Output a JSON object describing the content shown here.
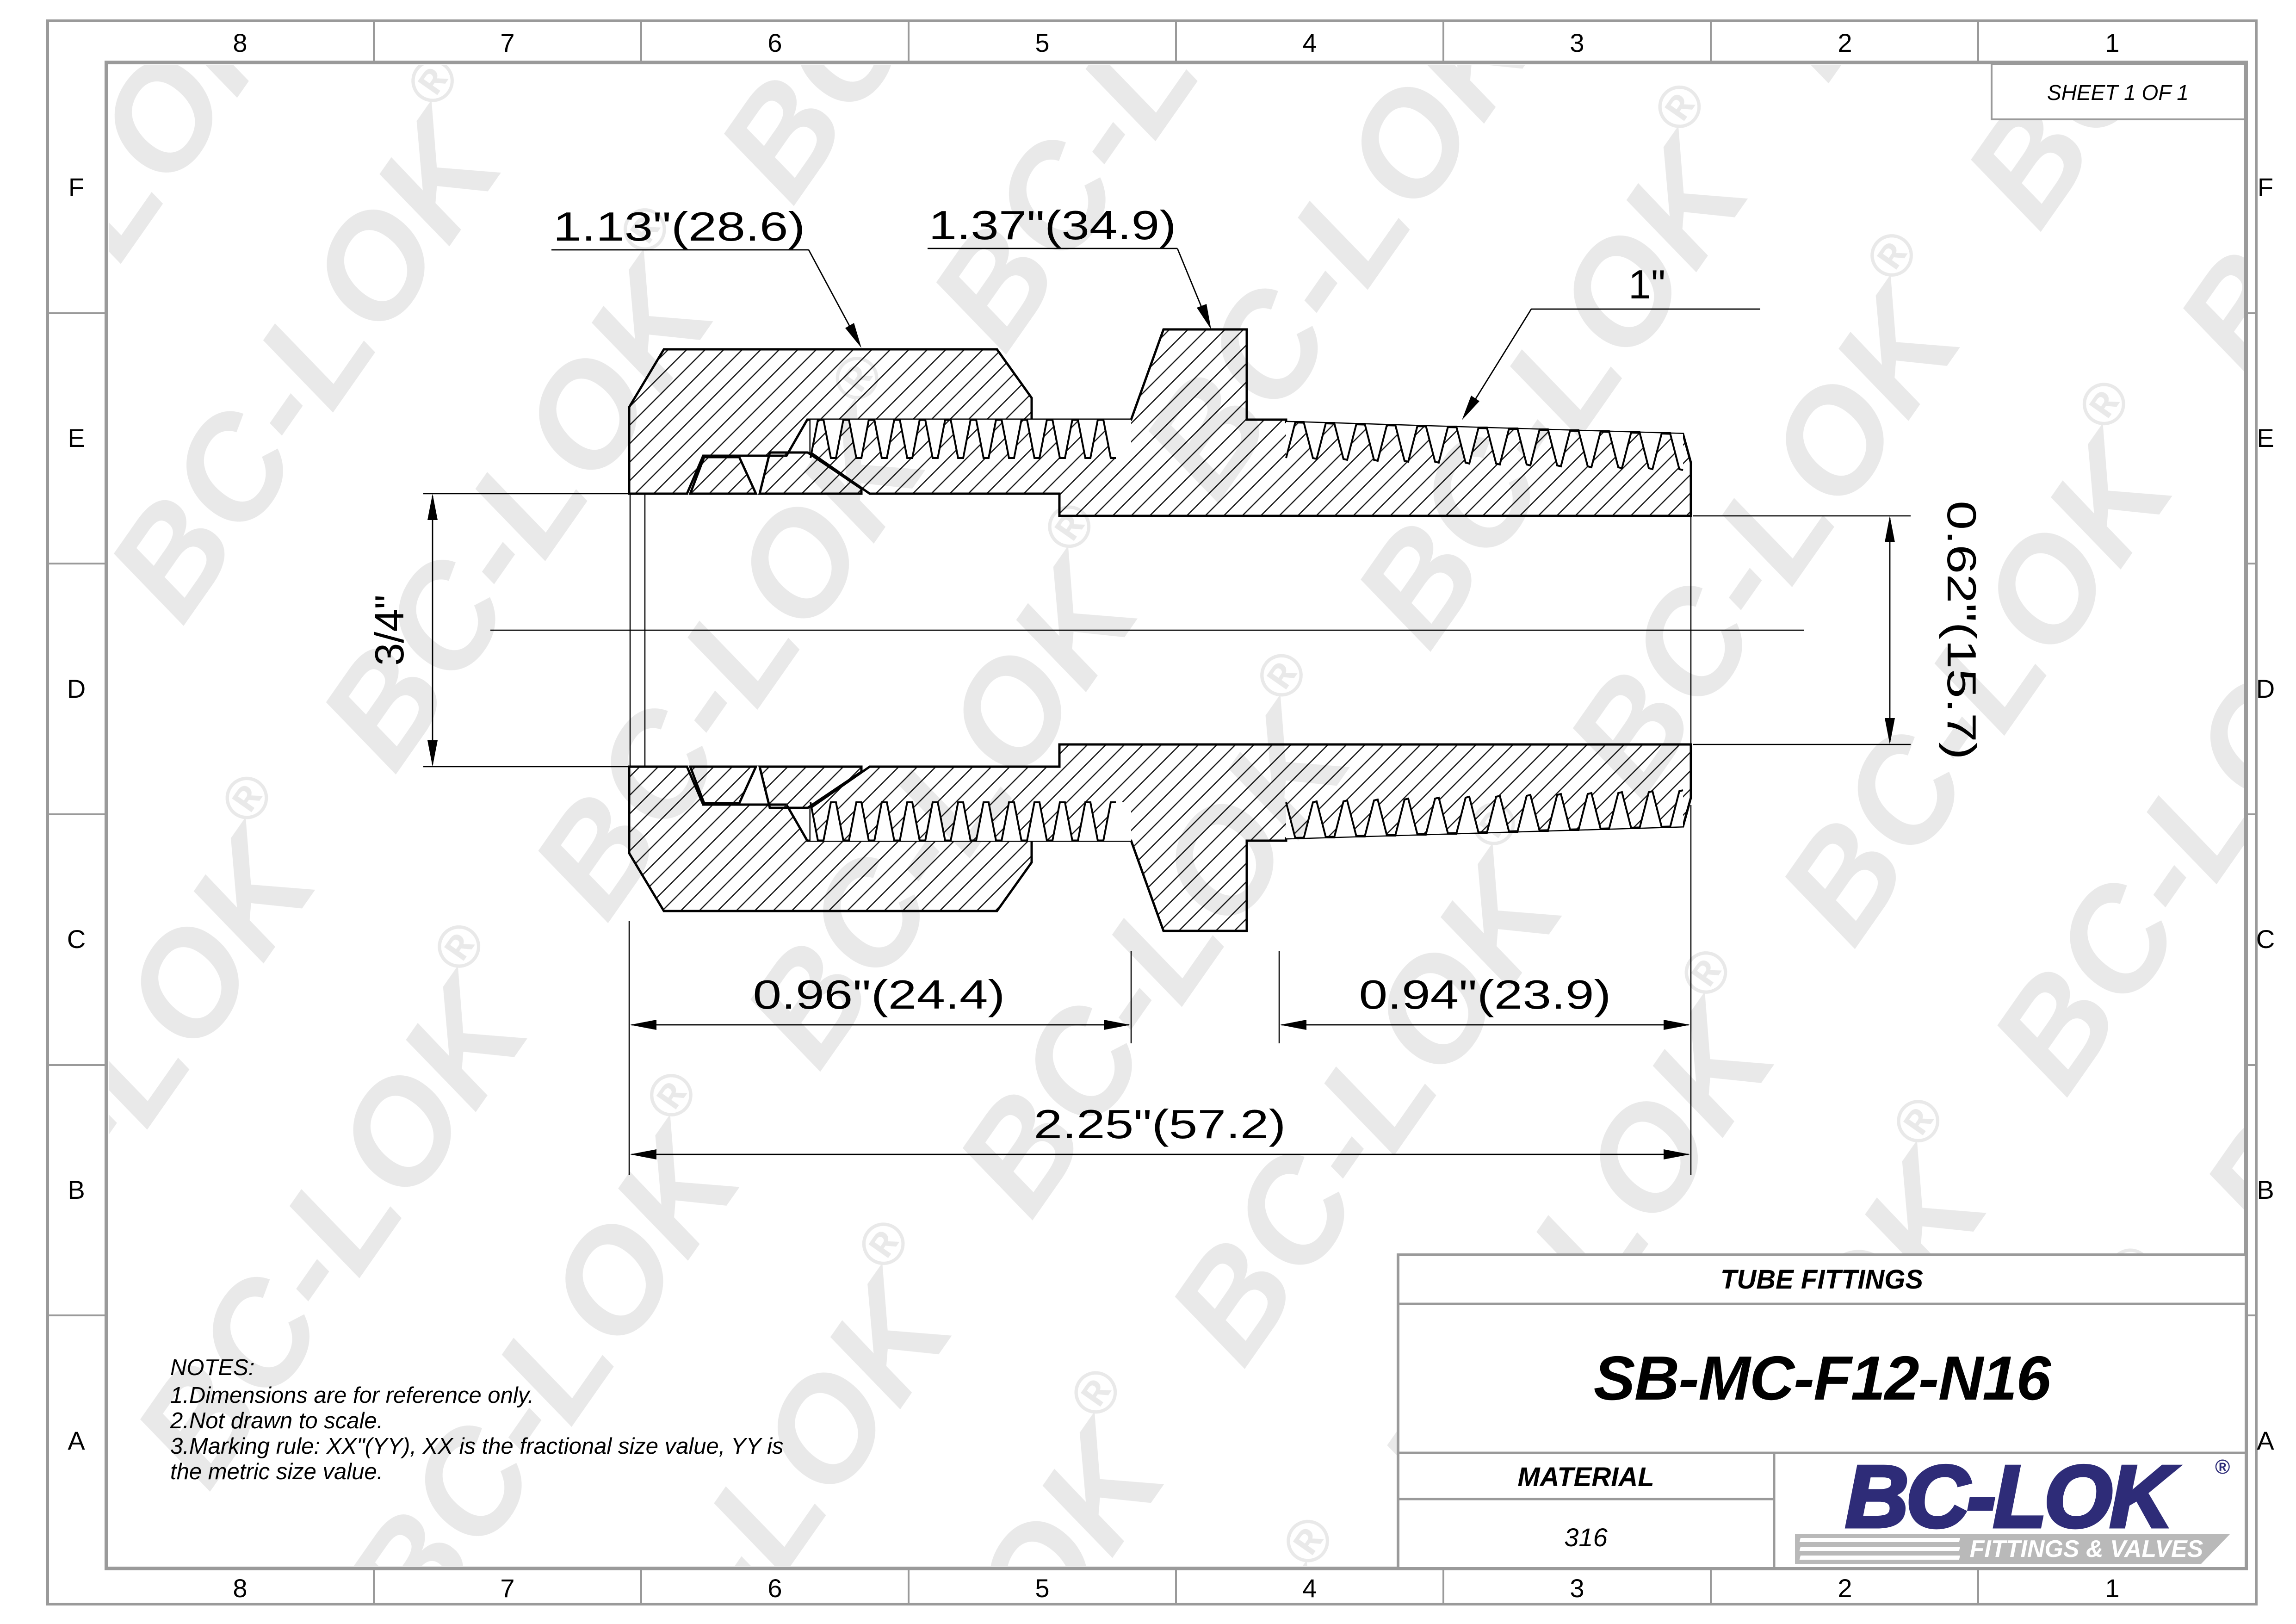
{
  "sheet_box": {
    "text": "SHEET 1 OF 1"
  },
  "grid_refs": {
    "columns": [
      "8",
      "7",
      "6",
      "5",
      "4",
      "3",
      "2",
      "1"
    ],
    "rows": [
      "F",
      "E",
      "D",
      "C",
      "B",
      "A"
    ]
  },
  "watermark": {
    "text": "BC-LOK",
    "reg": "®",
    "color": "#e9e9e9"
  },
  "drawing": {
    "labels": {
      "nut_flats": "1.13\"(28.6)",
      "body_hex_flats": "1.37\"(34.9)",
      "pipe_thread": "1\"",
      "tube_od": "3/4\"",
      "bore_dia": "0.62\"(15.7)",
      "nut_length": "0.96\"(24.4)",
      "thread_length": "0.94\"(23.9)",
      "overall_length": "2.25\"(57.2)"
    }
  },
  "notes": {
    "title": "NOTES:",
    "line1": "1.Dimensions are for reference only.",
    "line2": "2.Not drawn to scale.",
    "line3": "3.Marking rule: XX\"(YY), XX is the fractional size value, YY is",
    "line4": "the metric size value."
  },
  "title_block": {
    "category": "TUBE FITTINGS",
    "part_number": "SB-MC-F12-N16",
    "material_label": "MATERIAL",
    "material_value": "316",
    "logo": {
      "brand": "BC-LOK",
      "reg": "®",
      "tagline": "FITTINGS & VALVES",
      "brand_color": "#2e2c78",
      "banner_color": "#b9b9b9"
    }
  },
  "page": {
    "border_color": "#9a9a9a",
    "line_color": "#000000",
    "background": "#ffffff"
  }
}
